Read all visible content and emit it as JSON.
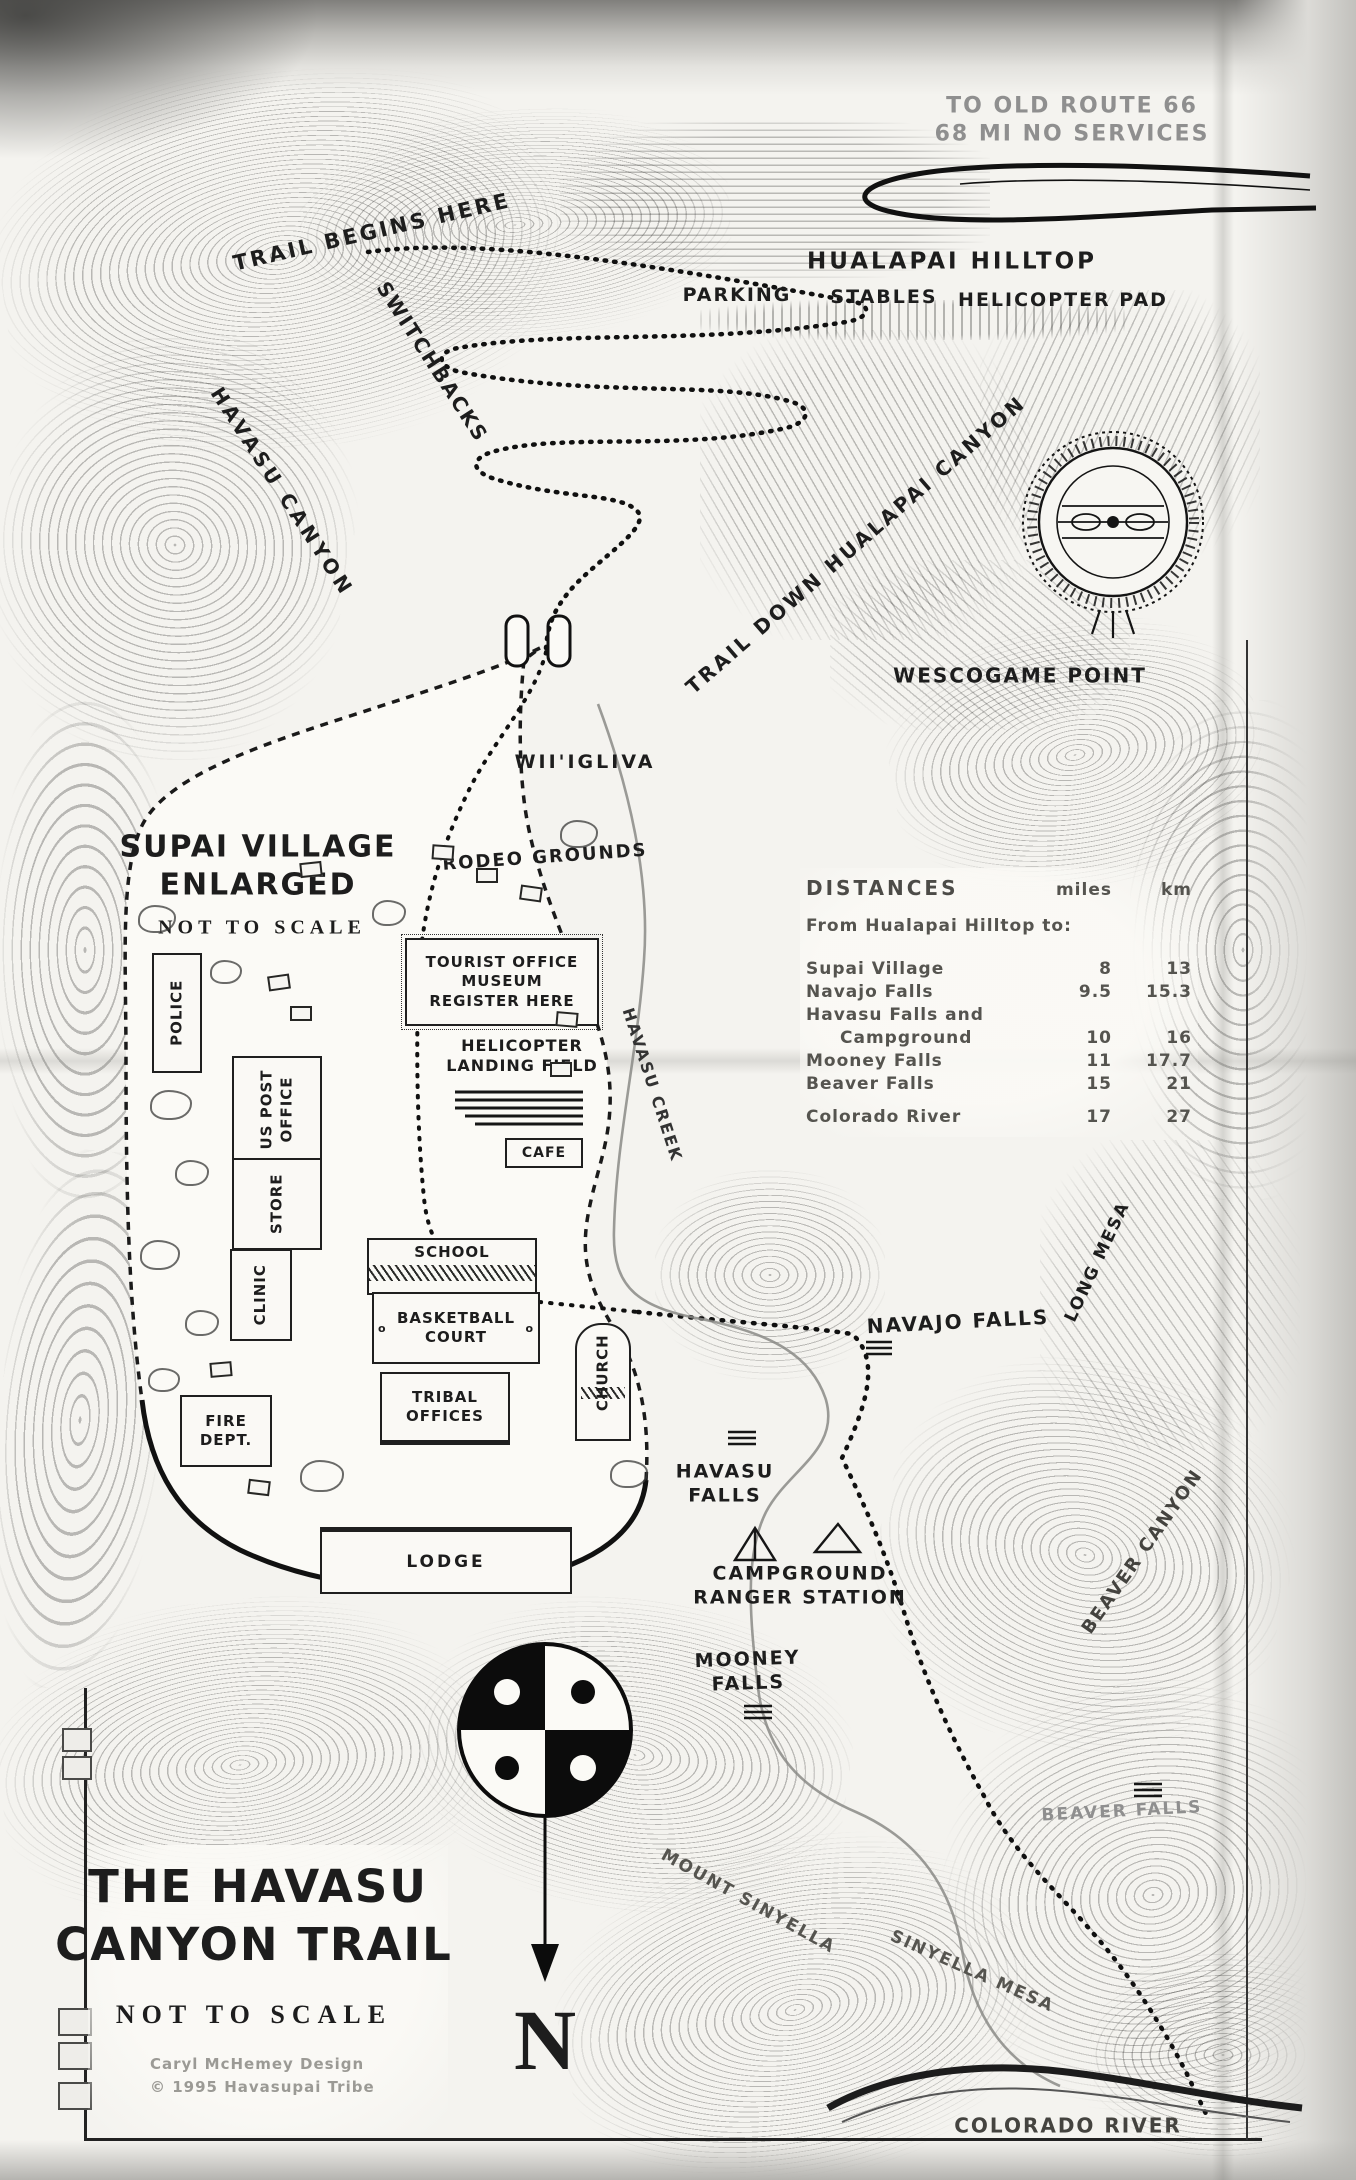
{
  "page_title": "The Havasu Canyon Trail — hand-drawn topographic trail map",
  "colors": {
    "ink": "#1d1d1d",
    "faded_ink": "#8f8f8f",
    "paper": "#f4f3ef"
  },
  "labels": {
    "route66_1": "TO OLD ROUTE 66",
    "route66_2": "68 MI NO SERVICES",
    "trail_begins": "TRAIL BEGINS HERE",
    "hualapai_hilltop": "HUALAPAI HILLTOP",
    "parking": "PARKING",
    "stables": "STABLES",
    "helicopter_pad": "HELICOPTER PAD",
    "switchbacks": "SWITCHBACKS",
    "havasu_canyon": "HAVASU CANYON",
    "trail_down_hualapai": "TRAIL DOWN HUALAPAI CANYON",
    "wescogame_point": "WESCOGAME POINT",
    "wiigliva": "WII'IGLIVA",
    "rodeo_grounds": "RODEO GROUNDS",
    "havasu_creek": "HAVASU CREEK",
    "navajo_falls": "NAVAJO FALLS",
    "long_mesa": "LONG MESA",
    "havasu_falls_1": "HAVASU",
    "havasu_falls_2": "FALLS",
    "campground_1": "CAMPGROUND",
    "campground_2": "RANGER STATION",
    "mooney_falls_1": "MOONEY",
    "mooney_falls_2": "FALLS",
    "beaver_canyon": "BEAVER CANYON",
    "beaver_falls": "BEAVER FALLS",
    "mount_sinyella": "MOUNT SINYELLA",
    "sinyella_mesa": "SINYELLA MESA",
    "colorado_river": "COLORADO RIVER"
  },
  "village": {
    "heading1": "SUPAI VILLAGE",
    "heading2": "ENLARGED",
    "scale_note": "NOT TO SCALE",
    "buildings": {
      "police": "POLICE",
      "us_post1": "US POST",
      "us_post2": "OFFICE",
      "store": "STORE",
      "clinic": "CLINIC",
      "fire1": "FIRE",
      "fire2": "DEPT.",
      "tourist1": "TOURIST OFFICE",
      "tourist2": "MUSEUM",
      "tourist3": "REGISTER HERE",
      "heli1": "HELICOPTER",
      "heli2": "LANDING FIELD",
      "cafe": "CAFE",
      "school": "SCHOOL",
      "court1": "BASKETBALL",
      "court2": "COURT",
      "tribal1": "TRIBAL",
      "tribal2": "OFFICES",
      "church": "CHURCH",
      "lodge": "LODGE"
    }
  },
  "distances": {
    "title": "DISTANCES",
    "col_miles": "miles",
    "col_km": "km",
    "from_line": "From Hualapai Hilltop to:",
    "rows": [
      {
        "l1": "Supai Village",
        "l2": "",
        "mi": "8",
        "km": "13"
      },
      {
        "l1": "Navajo Falls",
        "l2": "",
        "mi": "9.5",
        "km": "15.3"
      },
      {
        "l1": "Havasu Falls and",
        "l2": "Campground",
        "mi": "10",
        "km": "16"
      },
      {
        "l1": "Mooney Falls",
        "l2": "",
        "mi": "11",
        "km": "17.7"
      },
      {
        "l1": "Beaver Falls",
        "l2": "",
        "mi": "15",
        "km": "21"
      },
      {
        "l1": "Colorado River",
        "l2": "",
        "mi": "17",
        "km": "27"
      }
    ]
  },
  "title_block": {
    "line1": "THE HAVASU",
    "line2": "CANYON TRAIL",
    "scale_note": "NOT TO SCALE",
    "credit1": "Caryl McHemey Design",
    "credit2": "© 1995 Havasupai Tribe"
  },
  "compass": {
    "north_label": "N",
    "icon": "havasupai-four-quadrant-sun-symbol"
  }
}
